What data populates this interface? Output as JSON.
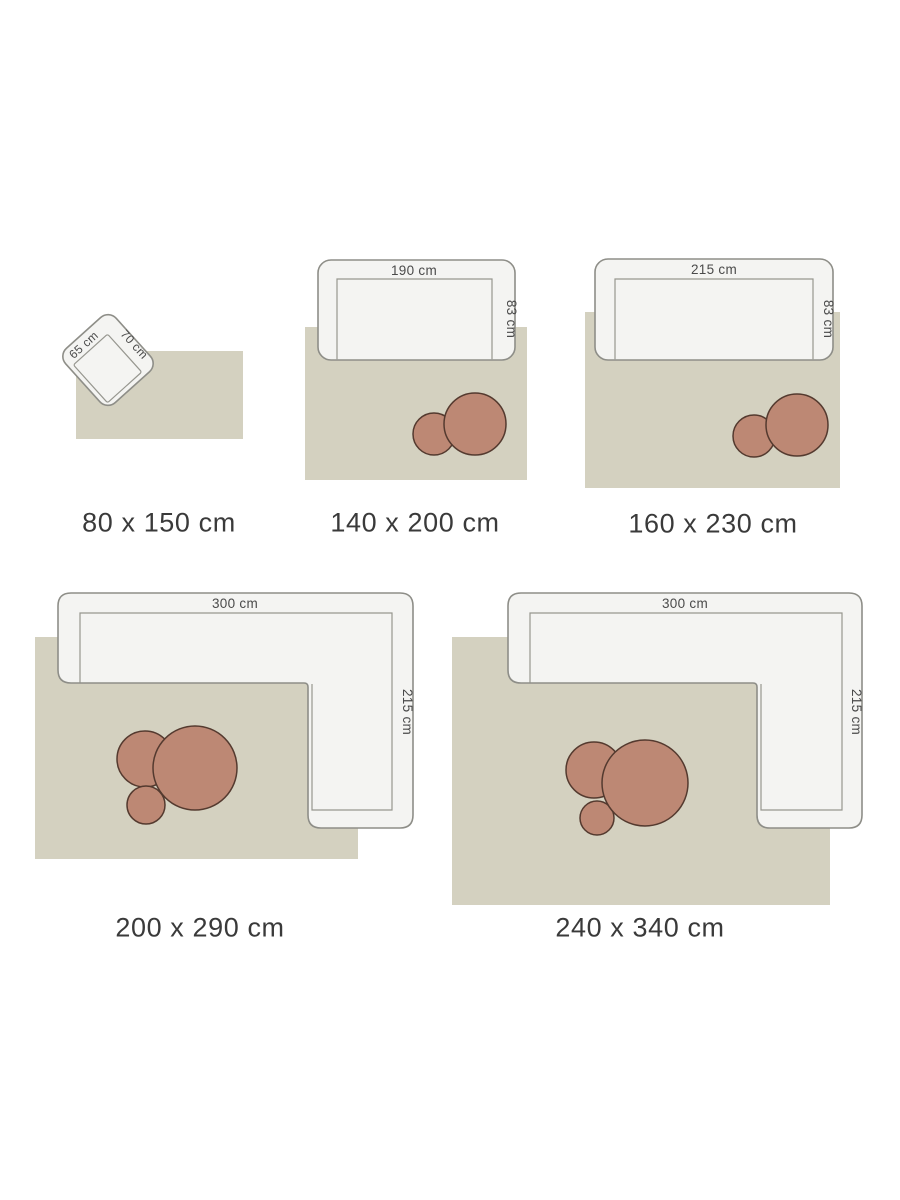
{
  "colors": {
    "background": "#ffffff",
    "rug_fill": "#d4d1c0",
    "furniture_fill": "#f4f4f2",
    "furniture_stroke": "#8e8e88",
    "seat_line": "#96968f",
    "table_fill": "#bd8874",
    "table_stroke": "#543a2f",
    "dim_text": "#4a4a4a",
    "label_text": "#3a3a3a"
  },
  "figures": [
    {
      "id": "rug-80x150",
      "size_label": "80 x 150 cm",
      "rug_width_cm": 80,
      "rug_length_cm": 150,
      "furniture": "armchair",
      "furniture_width_label": "65 cm",
      "furniture_depth_label": "70 cm",
      "coffee_tables": 0
    },
    {
      "id": "rug-140x200",
      "size_label": "140 x 200 cm",
      "rug_width_cm": 140,
      "rug_length_cm": 200,
      "furniture": "sofa",
      "furniture_width_label": "190 cm",
      "furniture_depth_label": "83 cm",
      "coffee_tables": 2
    },
    {
      "id": "rug-160x230",
      "size_label": "160 x 230 cm",
      "rug_width_cm": 160,
      "rug_length_cm": 230,
      "furniture": "sofa",
      "furniture_width_label": "215 cm",
      "furniture_depth_label": "83 cm",
      "coffee_tables": 2
    },
    {
      "id": "rug-200x290",
      "size_label": "200 x 290 cm",
      "rug_width_cm": 200,
      "rug_length_cm": 290,
      "furniture": "corner-sofa",
      "furniture_width_label": "300 cm",
      "furniture_depth_label": "215 cm",
      "coffee_tables": 3
    },
    {
      "id": "rug-240x340",
      "size_label": "240 x 340 cm",
      "rug_width_cm": 240,
      "rug_length_cm": 340,
      "furniture": "corner-sofa",
      "furniture_width_label": "300 cm",
      "furniture_depth_label": "215 cm",
      "coffee_tables": 3
    }
  ]
}
